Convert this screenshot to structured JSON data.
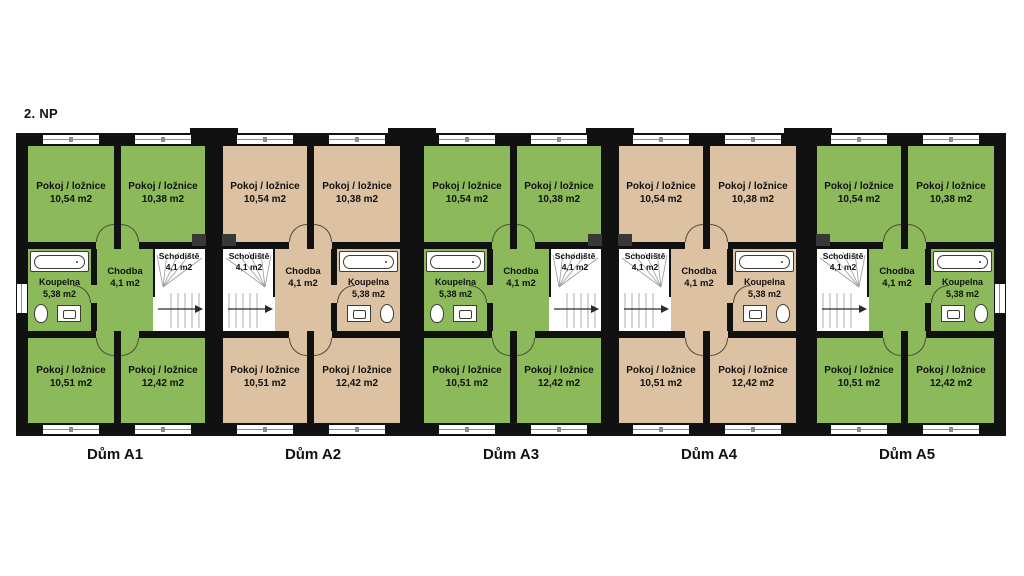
{
  "title": "2. NP",
  "colors": {
    "green": "#8cba5b",
    "tan": "#dcc2a2",
    "wall": "#111111",
    "stair_floor": "#ffffff"
  },
  "houses": [
    {
      "name": "Dům A1",
      "style": "green",
      "mirrored": false,
      "side_window": true,
      "top_rooms": [
        {
          "label": "Pokoj / ložnice",
          "area": "10,54 m2"
        },
        {
          "label": "Pokoj / ložnice",
          "area": "10,38 m2"
        }
      ],
      "bathroom": {
        "label": "Koupelna",
        "area": "5,38 m2"
      },
      "hall": {
        "label": "Chodba",
        "area": "4,1 m2"
      },
      "stairs": {
        "label": "Schodiště",
        "area": "4,1 m2"
      },
      "bottom_rooms": [
        {
          "label": "Pokoj / ložnice",
          "area": "10,51 m2"
        },
        {
          "label": "Pokoj / ložnice",
          "area": "12,42 m2"
        }
      ]
    },
    {
      "name": "Dům A2",
      "style": "tan",
      "mirrored": true,
      "side_window": false,
      "top_rooms": [
        {
          "label": "Pokoj / ložnice",
          "area": "10,38 m2"
        },
        {
          "label": "Pokoj / ložnice",
          "area": "10,54 m2"
        }
      ],
      "bathroom": {
        "label": "Koupelna",
        "area": "5,38 m2"
      },
      "hall": {
        "label": "Chodba",
        "area": "4,1 m2"
      },
      "stairs": {
        "label": "Schodiště",
        "area": "4,1 m2"
      },
      "bottom_rooms": [
        {
          "label": "Pokoj / ložnice",
          "area": "12,42 m2"
        },
        {
          "label": "Pokoj / ložnice",
          "area": "10,51 m2"
        }
      ]
    },
    {
      "name": "Dům A3",
      "style": "green",
      "mirrored": false,
      "side_window": false,
      "top_rooms": [
        {
          "label": "Pokoj / ložnice",
          "area": "10,54 m2"
        },
        {
          "label": "Pokoj / ložnice",
          "area": "10,38 m2"
        }
      ],
      "bathroom": {
        "label": "Koupelna",
        "area": "5,38 m2"
      },
      "hall": {
        "label": "Chodba",
        "area": "4,1 m2"
      },
      "stairs": {
        "label": "Schodiště",
        "area": "4,1 m2"
      },
      "bottom_rooms": [
        {
          "label": "Pokoj / ložnice",
          "area": "10,51 m2"
        },
        {
          "label": "Pokoj / ložnice",
          "area": "12,42 m2"
        }
      ]
    },
    {
      "name": "Dům A4",
      "style": "tan",
      "mirrored": true,
      "side_window": false,
      "top_rooms": [
        {
          "label": "Pokoj / ložnice",
          "area": "10,38 m2"
        },
        {
          "label": "Pokoj / ložnice",
          "area": "10,54 m2"
        }
      ],
      "bathroom": {
        "label": "Koupelna",
        "area": "5,38 m2"
      },
      "hall": {
        "label": "Chodba",
        "area": "4,1 m2"
      },
      "stairs": {
        "label": "Schodiště",
        "area": "4,1 m2"
      },
      "bottom_rooms": [
        {
          "label": "Pokoj / ložnice",
          "area": "12,42 m2"
        },
        {
          "label": "Pokoj / ložnice",
          "area": "10,51 m2"
        }
      ]
    },
    {
      "name": "Dům A5",
      "style": "green",
      "mirrored": true,
      "side_window": true,
      "top_rooms": [
        {
          "label": "Pokoj / ložnice",
          "area": "10,38 m2"
        },
        {
          "label": "Pokoj / ložnice",
          "area": "10,54 m2"
        }
      ],
      "bathroom": {
        "label": "Koupelna",
        "area": "5,38 m2"
      },
      "hall": {
        "label": "Chodba",
        "area": "4,1 m2"
      },
      "stairs": {
        "label": "Schodiště",
        "area": "4,1 m2"
      },
      "bottom_rooms": [
        {
          "label": "Pokoj / ložnice",
          "area": "12,42 m2"
        },
        {
          "label": "Pokoj / ložnice",
          "area": "10,51 m2"
        }
      ]
    }
  ]
}
